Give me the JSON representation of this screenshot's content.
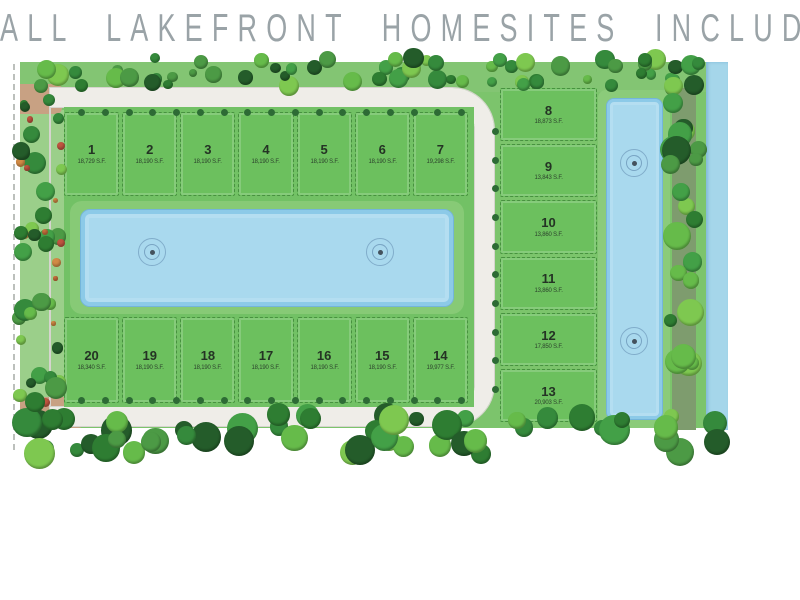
{
  "title": "ALL LAKEFRONT HOMESITES INCLUDED",
  "lots": {
    "top_row": [
      {
        "number": "1",
        "sqft": "18,729 S.F."
      },
      {
        "number": "2",
        "sqft": "18,190 S.F."
      },
      {
        "number": "3",
        "sqft": "18,190 S.F."
      },
      {
        "number": "4",
        "sqft": "18,190 S.F."
      },
      {
        "number": "5",
        "sqft": "18,190 S.F."
      },
      {
        "number": "6",
        "sqft": "18,190 S.F."
      },
      {
        "number": "7",
        "sqft": "19,298 S.F."
      }
    ],
    "right_column": [
      {
        "number": "8",
        "sqft": "18,873 S.F."
      },
      {
        "number": "9",
        "sqft": "13,843 S.F."
      },
      {
        "number": "10",
        "sqft": "13,860 S.F."
      },
      {
        "number": "11",
        "sqft": "13,860 S.F."
      },
      {
        "number": "12",
        "sqft": "17,850 S.F."
      },
      {
        "number": "13",
        "sqft": "20,903 S.F."
      }
    ],
    "bottom_row": [
      {
        "number": "20",
        "sqft": "18,340 S.F."
      },
      {
        "number": "19",
        "sqft": "18,190 S.F."
      },
      {
        "number": "18",
        "sqft": "18,190 S.F."
      },
      {
        "number": "17",
        "sqft": "18,190 S.F."
      },
      {
        "number": "16",
        "sqft": "18,190 S.F."
      },
      {
        "number": "15",
        "sqft": "18,190 S.F."
      },
      {
        "number": "14",
        "sqft": "19,977 S.F."
      }
    ]
  },
  "features": {
    "central_lake": "lake with two fountains",
    "east_lake": "lake with two fountains",
    "canal": "waterway along east boundary",
    "fountain_icon": "concentric-circle fountain",
    "tree_icon": "round canopy tree"
  },
  "colors": {
    "base_green": "#7cc46c",
    "lot_green": "#6cc05e",
    "lake_blue": "#a9d9ee",
    "lake_edge": "#8ccae8",
    "canal_blue": "#a5d6ea",
    "road": "#efede8",
    "beige": "#c8a183",
    "title_gray": "#9aa3a7"
  }
}
